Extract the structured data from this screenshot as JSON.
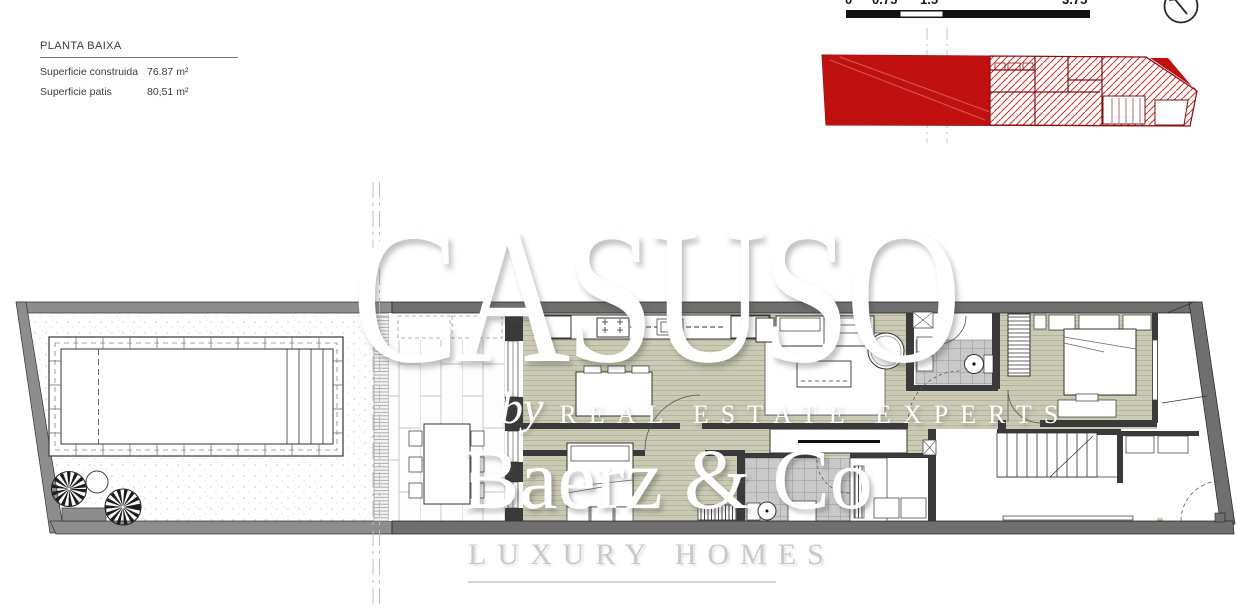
{
  "title_block": {
    "title": "PLANTA BAIXA",
    "rows": [
      {
        "label": "Superficie construida",
        "value": "76.87 m²"
      },
      {
        "label": "Superficie patis",
        "value": "80,51 m²"
      }
    ]
  },
  "scale_bar": {
    "labels": [
      "0",
      "0.75",
      "1.5",
      "3.75"
    ]
  },
  "watermarks": {
    "brand": "CASUSO",
    "byline_script": "by",
    "byline_caps": "REAL ESTATE EXPERTS",
    "agency": "Baerz & Co",
    "agency_tagline": "LUXURY HOMES"
  },
  "colors": {
    "keyplan_red": "#c01010",
    "keyplan_hatch": "#cc3333",
    "interior_floor": "#ccccb6",
    "bath_tile": "#c9c9c9",
    "wall_dark": "#3a3a3a",
    "wall_gray": "#6f6f6f"
  }
}
